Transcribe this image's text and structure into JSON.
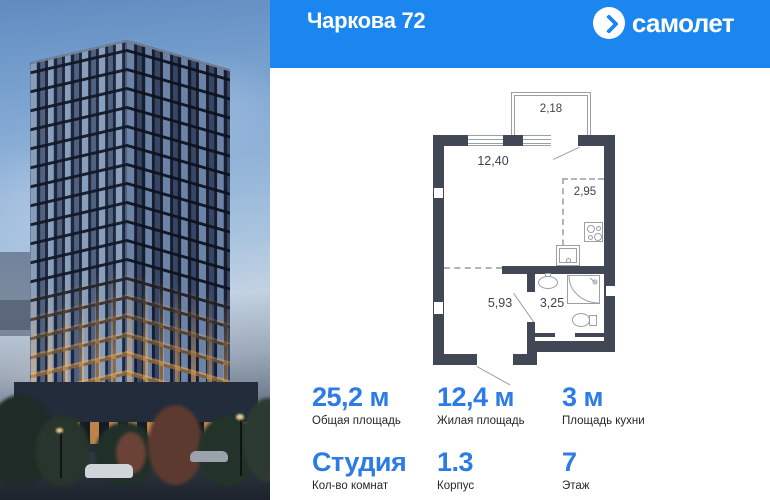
{
  "header": {
    "title": "Чаркова 72",
    "brand": "самолет",
    "logo_icon": "chevron-right-in-circle"
  },
  "floorplan": {
    "areas": {
      "balcony": "2,18",
      "living": "12,40",
      "kitchen": "2,95",
      "hallway": "5,93",
      "bathroom": "3,25"
    },
    "icons": [
      "stove-icon",
      "kitchen-sink-icon",
      "bath-sink-icon",
      "shower-icon",
      "toilet-icon"
    ]
  },
  "stats": {
    "cells": [
      {
        "value": "25,2 м",
        "label": "Общая площадь"
      },
      {
        "value": "12,4 м",
        "label": "Жилая площадь"
      },
      {
        "value": "3 м",
        "label": "Площадь кухни"
      },
      {
        "value": "Студия",
        "label": "Кол-во комнат"
      },
      {
        "value": "1.3",
        "label": "Корпус"
      },
      {
        "value": "7",
        "label": "Этаж"
      }
    ]
  },
  "colors": {
    "header_blue": "#1b86f0",
    "accent_blue": "#2b7ce6",
    "plan_wall": "#414754",
    "plan_line": "#9aa0a8",
    "label_dark": "#23272e"
  }
}
